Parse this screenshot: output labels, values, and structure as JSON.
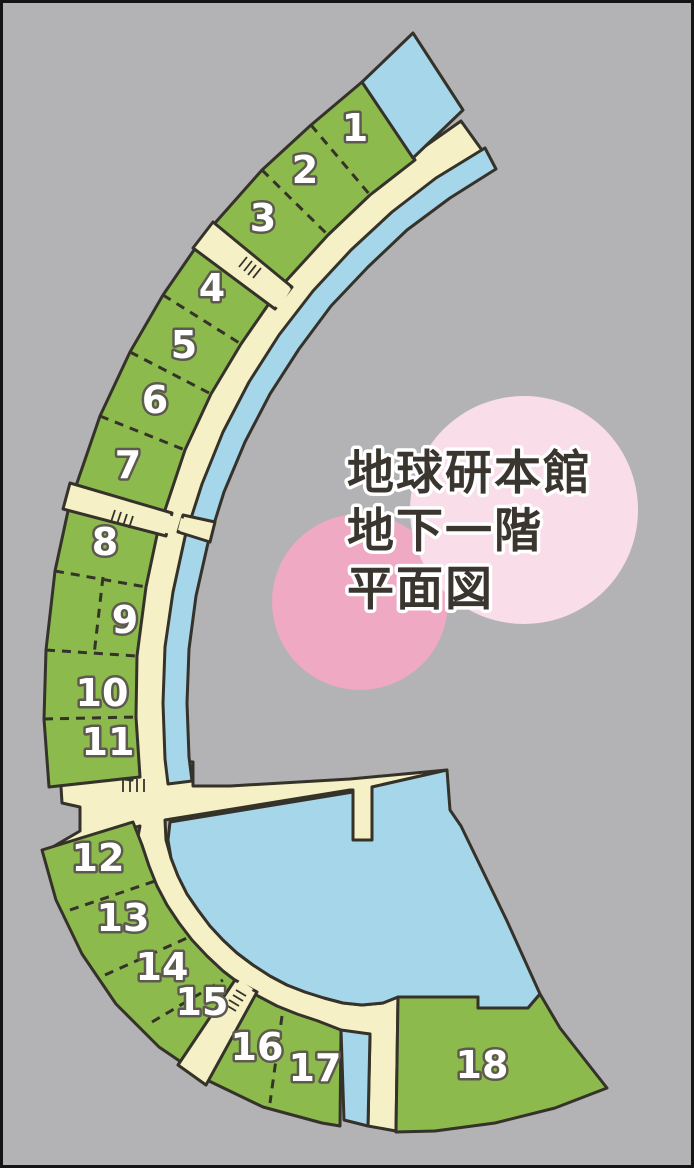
{
  "title": {
    "line1": "地球研本館",
    "line2": "地下一階",
    "line3": "平面図"
  },
  "rooms": [
    {
      "n": "1",
      "x": 355,
      "y": 141
    },
    {
      "n": "2",
      "x": 305,
      "y": 183
    },
    {
      "n": "3",
      "x": 263,
      "y": 231
    },
    {
      "n": "4",
      "x": 212,
      "y": 301
    },
    {
      "n": "5",
      "x": 184,
      "y": 358
    },
    {
      "n": "6",
      "x": 155,
      "y": 413
    },
    {
      "n": "7",
      "x": 128,
      "y": 478
    },
    {
      "n": "8",
      "x": 105,
      "y": 555
    },
    {
      "n": "9",
      "x": 125,
      "y": 633
    },
    {
      "n": "10",
      "x": 102,
      "y": 706
    },
    {
      "n": "11",
      "x": 108,
      "y": 755
    },
    {
      "n": "12",
      "x": 98,
      "y": 871
    },
    {
      "n": "13",
      "x": 123,
      "y": 931
    },
    {
      "n": "14",
      "x": 162,
      "y": 980
    },
    {
      "n": "15",
      "x": 202,
      "y": 1015
    },
    {
      "n": "16",
      "x": 257,
      "y": 1060
    },
    {
      "n": "17",
      "x": 315,
      "y": 1081
    },
    {
      "n": "18",
      "x": 482,
      "y": 1078
    }
  ],
  "colors": {
    "background": "#b3b3b5",
    "room_green": "#8cba4d",
    "corridor_cream": "#f5f0c6",
    "water_blue": "#a5d6ea",
    "outline": "#35322a",
    "circle_large_pink": "#f9dde9",
    "circle_small_pink": "#f0a9c3",
    "room_label_fill": "#ffffff",
    "room_label_halo": "#5d594f",
    "title_color": "#3a362f"
  }
}
